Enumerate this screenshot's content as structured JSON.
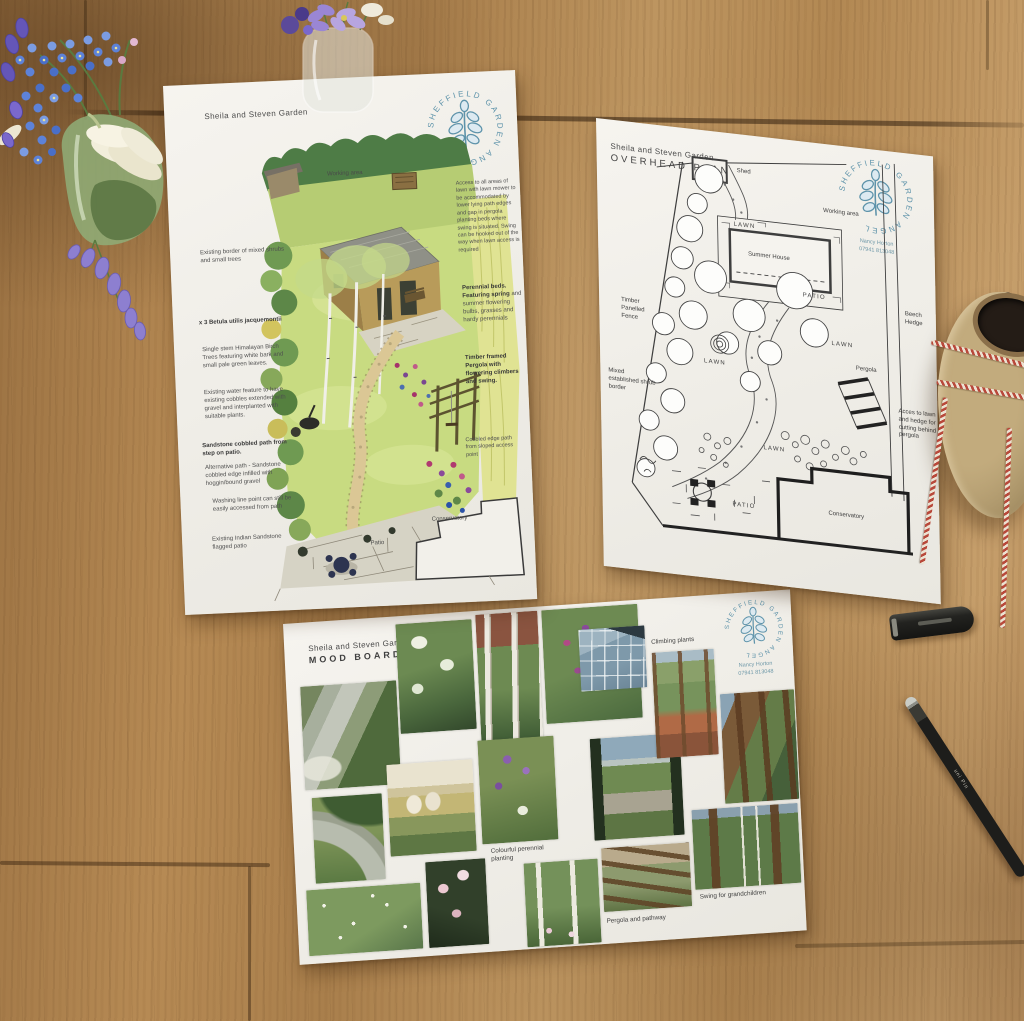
{
  "brand": {
    "logo_text": "SHEFFIELD GARDEN ANGEL",
    "logo_color": "#5e93aa",
    "contact_name": "Nancy Horton",
    "contact_phone": "07941 813048"
  },
  "colors": {
    "table_wood": "#b08a57",
    "paper": "#f2f0ea",
    "twine_red": "#b8483a",
    "watercolor_lawn": "#c8db81"
  },
  "illustration_sheet": {
    "title": "Sheila and Steven Garden",
    "drawing_labels": {
      "working_area": "Working area",
      "patio": "Patio",
      "conservatory": "Conservatory"
    },
    "left_notes": [
      {
        "text": "Existing border of mixed shrubs and small trees"
      },
      {
        "text": "x 3 Betula utilis jacquemontii"
      },
      {
        "text": "Single stem Himalayan Birch Trees featuring white bark and small pale green leaves."
      },
      {
        "text": "Existing water feature to have existing cobbles extended with gravel and interplanted with suitable plants."
      },
      {
        "text": "Sandstone cobbled path from step on patio."
      },
      {
        "text": "Alternative path - Sandstone cobbled edge infilled with hoggin/bound gravel"
      },
      {
        "text": "Washing line point can still be easily accessed from path"
      },
      {
        "text": "Existing Indian Sandstone flagged patio"
      }
    ],
    "right_notes": [
      {
        "lead": "",
        "text": "Access to all areas of lawn with lawn mower to be accommodated by lower lying path edges and gap in pergola planting beds where swing is situated. Swing can be hooked out of the way when lawn access is required"
      },
      {
        "lead": "Perennial beds. Featuring spring",
        "text": "and summer flowering bulbs, grasses and hardy perennials"
      },
      {
        "lead": "Timber framed Pergola with flowering climbers and swing.",
        "text": ""
      },
      {
        "lead": "",
        "text": "Cobbled edge path from sloped access point"
      }
    ]
  },
  "plan_sheet": {
    "title": "Sheila and Steven Garden",
    "subtitle": "OVERHEAD PLAN",
    "labels": {
      "shed": "Shed",
      "working_area": "Working area",
      "lawn": "LAWN",
      "summer_house": "Summer House",
      "patio": "PATIO",
      "timber_fence": "Timber Panelled Fence",
      "mixed_border": "Mixed established shrub border",
      "beech_hedge": "Beech Hedge",
      "pergola": "Pergola",
      "access_note": "Acces to lawn and hedge for cutting behind pergola",
      "conservatory": "Conservatory"
    }
  },
  "mood_board": {
    "title": "Sheila and Steven Garden",
    "subtitle": "MOOD BOARD",
    "captions": [
      "Indian Sandstone cobbles",
      "Climbing plants",
      "Colourful perennial planting",
      "Pergola and pathway",
      "Swing for grandchildren"
    ]
  },
  "scene": {
    "pen_label": "uni Pin"
  }
}
